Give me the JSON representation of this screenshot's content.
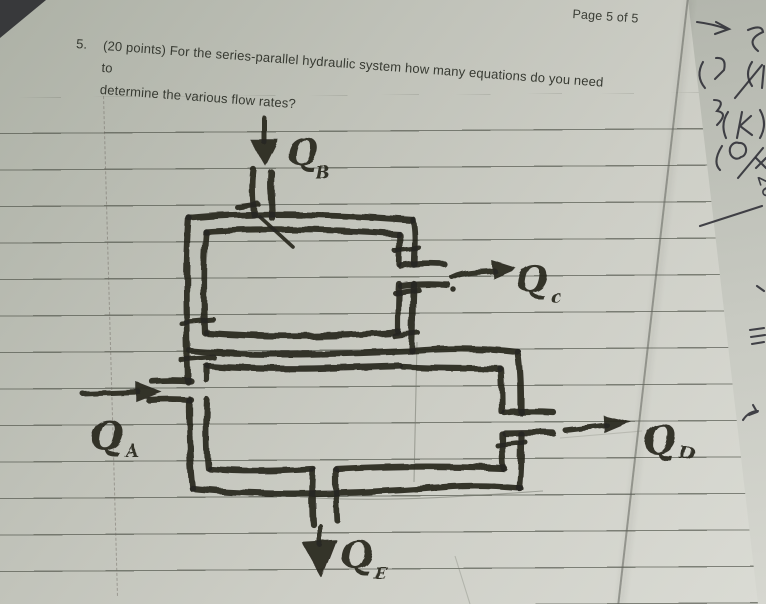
{
  "page": {
    "page_label": "Page 5 of 5"
  },
  "question": {
    "number": "5.",
    "line1": "(20 points) For the series-parallel hydraulic system how many equations do you need to",
    "line2": "determine the various flow rates?"
  },
  "diagram": {
    "type": "hand-drawn series-parallel hydraulic pipe circuit, two stacked rectangular loops",
    "flows": [
      {
        "symbol": "Q",
        "subscript": "B",
        "arrow_direction": "down",
        "position": "top-inlet"
      },
      {
        "symbol": "Q",
        "subscript": "c",
        "arrow_direction": "right",
        "position": "upper-right-outlet"
      },
      {
        "symbol": "Q",
        "subscript": "A",
        "arrow_direction": "right",
        "position": "left-inlet"
      },
      {
        "symbol": "Q",
        "subscript": "D",
        "arrow_direction": "right",
        "position": "lower-right-outlet"
      },
      {
        "symbol": "Q",
        "subscript": "E",
        "arrow_direction": "down",
        "position": "bottom-outlet"
      }
    ]
  },
  "margin_notes": {
    "glyphs": [
      "2",
      "3",
      "(k",
      "5",
      "8",
      "20"
    ]
  },
  "colors": {
    "paper": "#c6c8c0",
    "ink": "#292620",
    "ruled_line": "#6f726a",
    "background": "#38393b",
    "printed_text": "#373a32"
  }
}
